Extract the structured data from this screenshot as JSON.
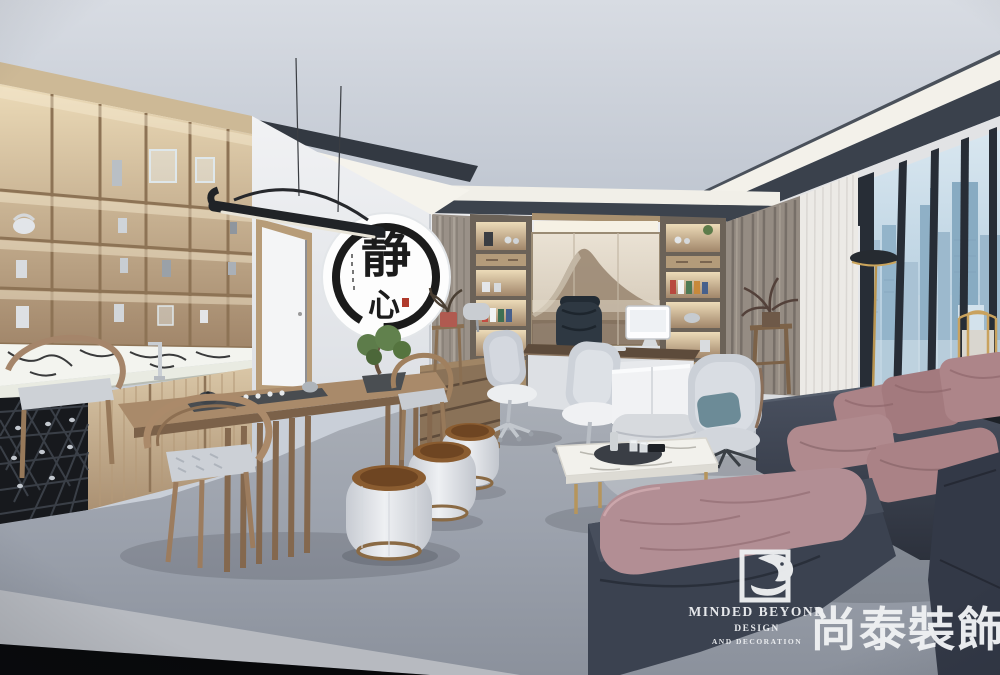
{
  "scene": {
    "description": "3D interior render of a modern Chinese-style executive office: backlit oak display shelving and a marble tea bar with wine rack on the left, a walnut tea table with horseshoe armchairs and fabric drum stools, an executive desk with black leather chair before an ink-wash mountain triptych flanked by lit bookshelf niches and curtains, and a charcoal sofa with dusty-pink cushions, marble coffee table and grey wing chair facing floor-to-ceiling windows over a hazy city skyline"
  },
  "wall_art": {
    "name": "circular ink calligraphy panel",
    "char_top": "静",
    "char_bottom": "心",
    "ink_color": "#1b1b1b",
    "seal_color": "#b03a2c"
  },
  "watermark": {
    "logo_icon": "eagle-in-square-icon",
    "brand_en": "MINDED BEYOND",
    "line2": "DESIGN",
    "line3": "AND DECORATION",
    "brand_cn": "尚泰裝飾",
    "color": "#edeff2"
  },
  "palette": {
    "ceiling": "#c9cfd8",
    "cove_glow": "#f6f4ed",
    "wood_shelving": "#b69a76",
    "marble": "#f3f4ef",
    "floor": "#9aa0ab",
    "sofa_frame": "#3b4250",
    "sofa_cushion_pink": "#ab8387",
    "wing_chair": "#cbd0d7",
    "teal_pillow": "#6c8b97",
    "brass": "#b6955c",
    "sky": "#b9d2e2",
    "curtain_grey": "#958c83",
    "painting_mountain": "#9b8873"
  }
}
